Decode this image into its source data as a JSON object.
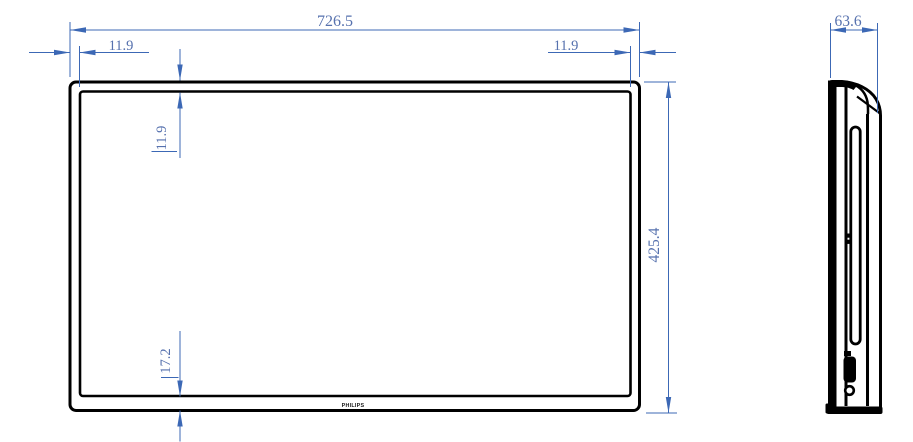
{
  "brand_logo": "PHILIPS",
  "colors": {
    "outline": "#000000",
    "dimension_line": "#3c68b5",
    "dimension_text": "#5671ae",
    "background": "#ffffff"
  },
  "dimensions": {
    "overall_width": "726.5",
    "overall_height": "425.4",
    "depth": "63.6",
    "bezel_left": "11.9",
    "bezel_right": "11.9",
    "bezel_top": "11.9",
    "bezel_bottom": "17.2"
  }
}
